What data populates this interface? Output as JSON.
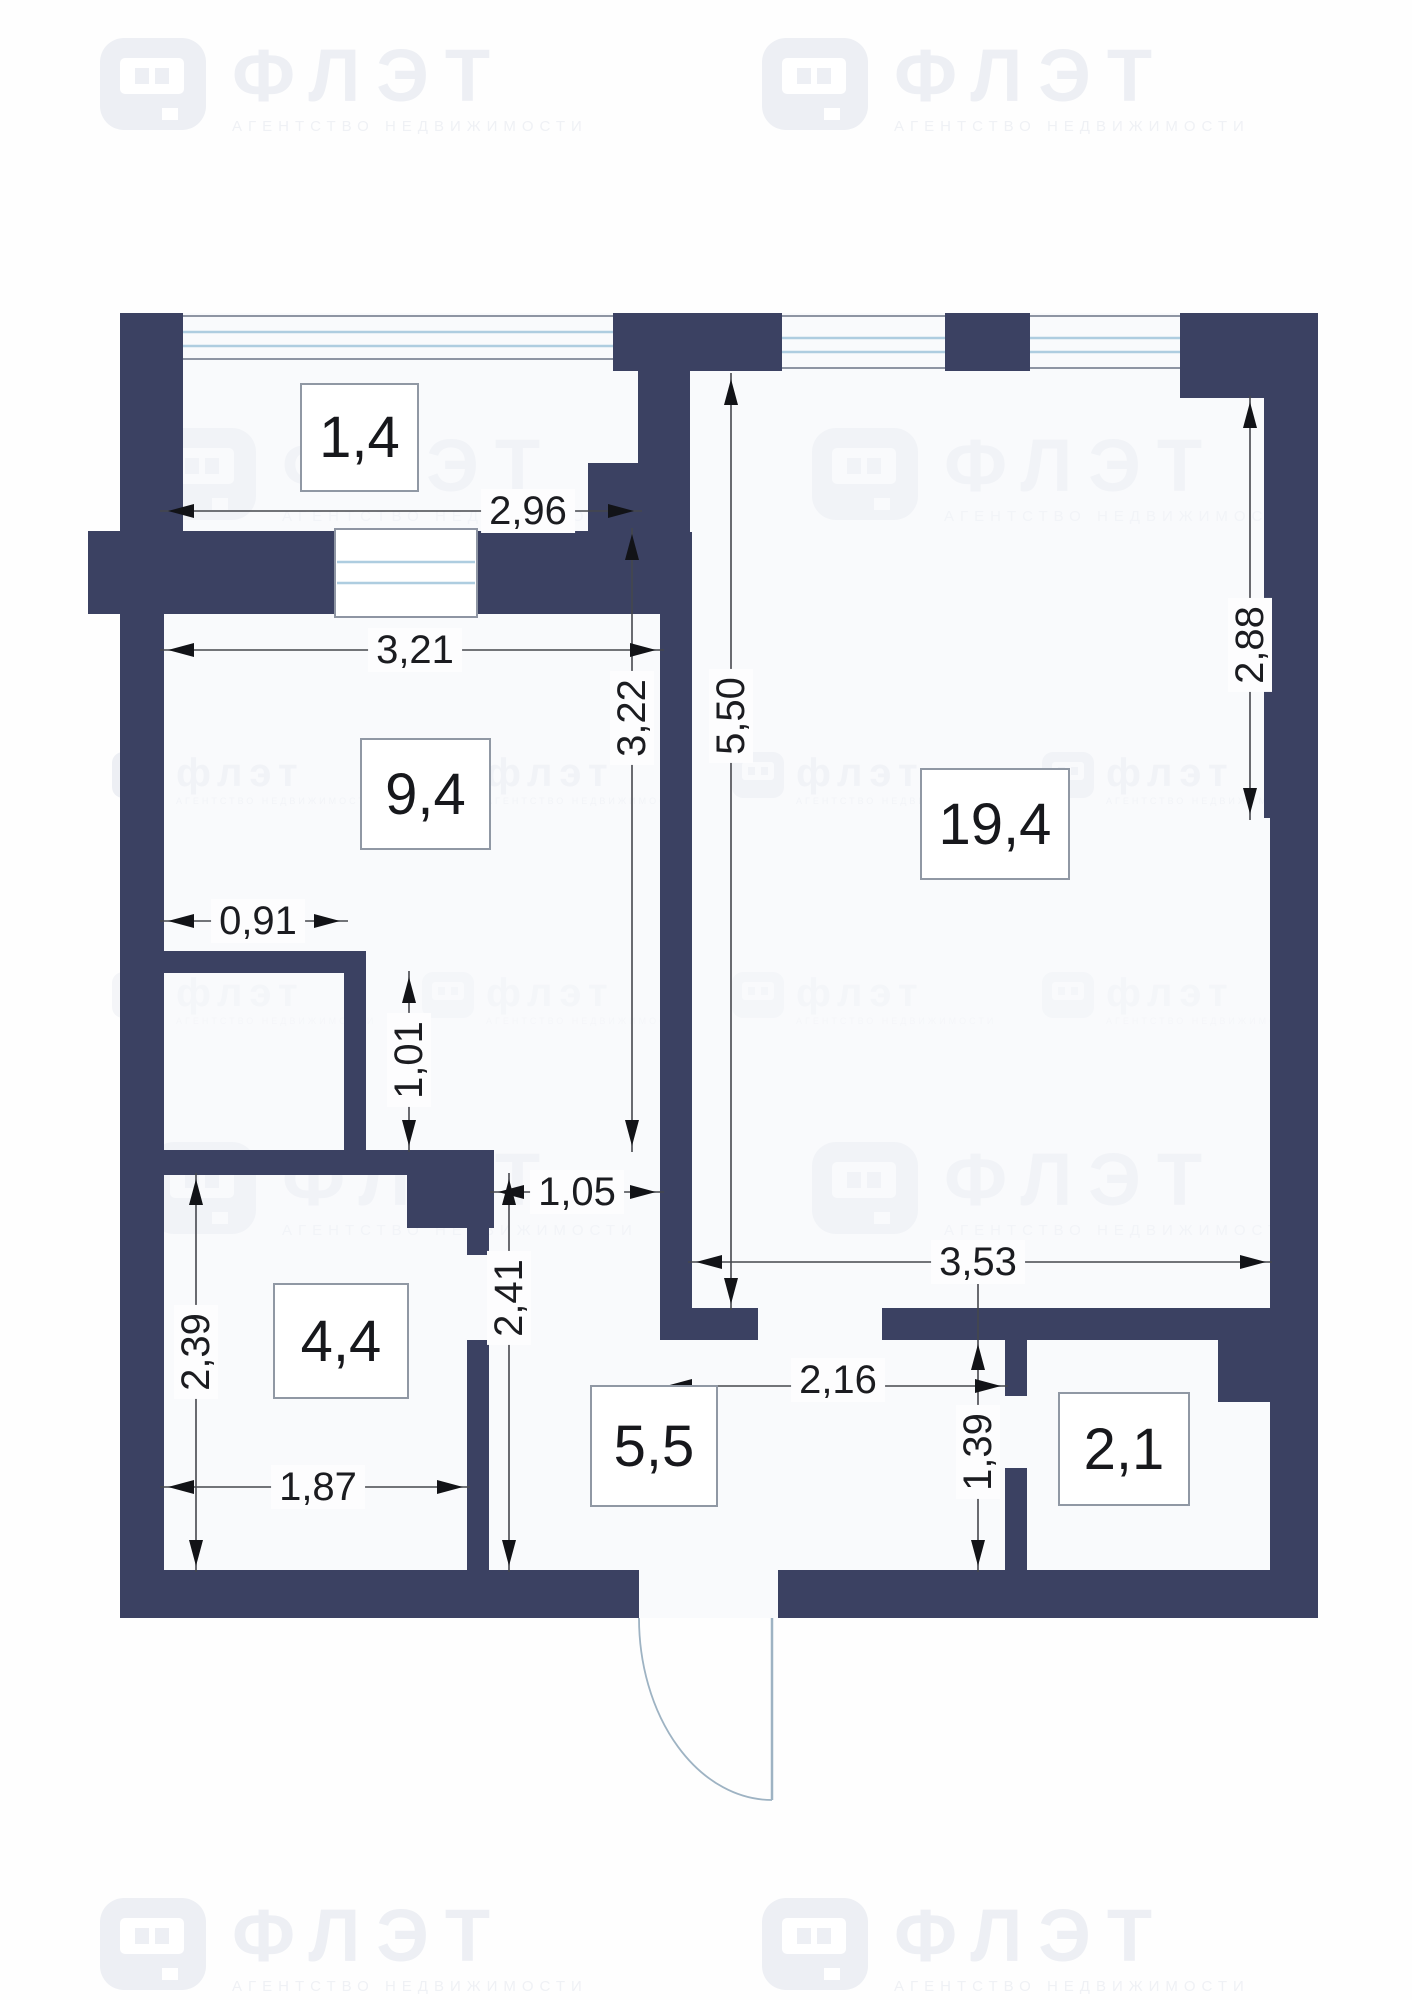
{
  "watermark": {
    "brand": "ФЛЭТ",
    "brand_small": "флэт",
    "tagline": "АГЕНТСТВО НЕДВИЖИМОСТИ"
  },
  "rooms": [
    {
      "key": "balcony",
      "area": "1,4"
    },
    {
      "key": "bedroom",
      "area": "9,4"
    },
    {
      "key": "living",
      "area": "19,4"
    },
    {
      "key": "wardrobe",
      "area": "4,4"
    },
    {
      "key": "hallway",
      "area": "5,5"
    },
    {
      "key": "bathroom",
      "area": "2,1"
    }
  ],
  "dims": {
    "w296": "2,96",
    "w321": "3,21",
    "h322": "3,22",
    "h550": "5,50",
    "h288": "2,88",
    "w091": "0,91",
    "h101": "1,01",
    "w105": "1,05",
    "h241": "2,41",
    "h239": "2,39",
    "w187": "1,87",
    "w216": "2,16",
    "h139": "1,39",
    "w353": "3,53"
  }
}
